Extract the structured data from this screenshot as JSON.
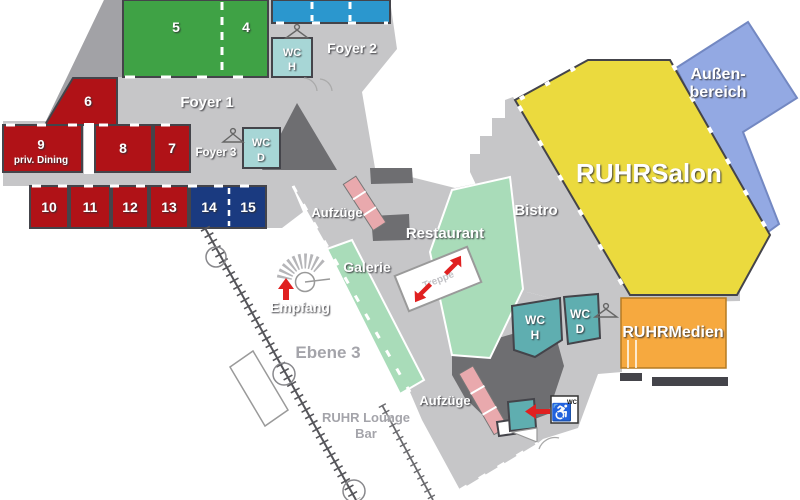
{
  "plan": {
    "level_label": "Ebene 3",
    "colors": {
      "floor": "#c6c6c8",
      "floor_dark": "#a2a2a6",
      "core": "#6e6e71",
      "wall": "#44444a",
      "room_red": "#b01217",
      "room_green": "#3fa245",
      "room_cyan": "#2b97ce",
      "room_navy": "#1a3a80",
      "wc_teal_light": "#a7d6d6",
      "wc_teal": "#5faeb0",
      "mint": "#a9dcb9",
      "salon_yellow": "#ebda3e",
      "outdoor_blue": "#93a9e3",
      "outdoor_border": "#7388c2",
      "medien_orange": "#f6a93f",
      "lift_pink": "#e9a9ad",
      "arrow_red": "#e02020"
    },
    "areas": {
      "foyer1": "Foyer 1",
      "foyer2": "Foyer 2",
      "foyer3": "Foyer 3",
      "restaurant": "Restaurant",
      "galerie": "Galerie",
      "bistro": "Bistro",
      "empfang": "Empfang",
      "treppe": "Treppe",
      "salon": "RUHRSalon",
      "aussen_line1": "Außen-",
      "aussen_line2": "bereich",
      "medien": "RUHRMedien",
      "lounge_line1": "RUHR Lounge",
      "lounge_line2": "Bar",
      "aufzuege_upper": "Aufzüge",
      "aufzuege_lower": "Aufzüge"
    },
    "rooms": [
      {
        "num": "5"
      },
      {
        "num": "4"
      },
      {
        "num": "6"
      },
      {
        "num": "9",
        "sub": "priv. Dining"
      },
      {
        "num": "8"
      },
      {
        "num": "7"
      },
      {
        "num": "10"
      },
      {
        "num": "11"
      },
      {
        "num": "12"
      },
      {
        "num": "13"
      },
      {
        "num": "14"
      },
      {
        "num": "15"
      }
    ],
    "wc": {
      "wc": "WC",
      "h": "H",
      "d": "D",
      "sign": "WC",
      "wheelchair": "♿"
    }
  }
}
